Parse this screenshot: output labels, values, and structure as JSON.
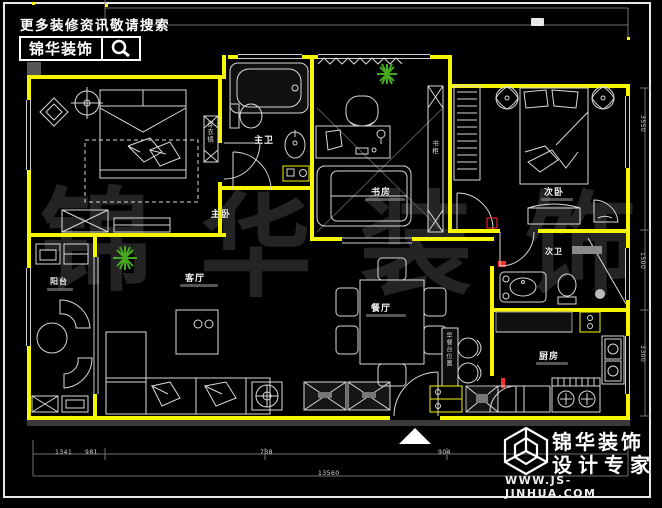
{
  "header": {
    "slogan": "更多装修资讯敬请搜索",
    "brand": "锦华装饰",
    "search_icon": "magnifier-icon"
  },
  "rooms": {
    "master_bedroom": "主卧",
    "master_bath": "主卫",
    "study": "书房",
    "second_bedroom": "次卧",
    "second_bath": "次卫",
    "living_room": "客厅",
    "dining_room": "餐厅",
    "kitchen": "厨房",
    "balcony": "阳台"
  },
  "fixtures": {
    "wardrobe_mirror": "穿衣镜",
    "bookcase": "书柜",
    "bar_cabinet": "早餐台位置"
  },
  "dimensions": {
    "b1": "1341",
    "b2": "981",
    "b3": "738",
    "b4": "904",
    "total": "13560",
    "r1": "3550",
    "r2": "1500",
    "r3": "3300"
  },
  "watermark": {
    "c1": "锦",
    "c2": "华",
    "c3": "装",
    "c4": "饰"
  },
  "footer": {
    "brand": "锦华装饰",
    "tagline": "设计专家",
    "url": "WWW.JS-JINHUA.COM"
  },
  "colors": {
    "wall": "#f6f600",
    "accent_red": "#ff2d2d",
    "plant_green": "#46a81c"
  }
}
